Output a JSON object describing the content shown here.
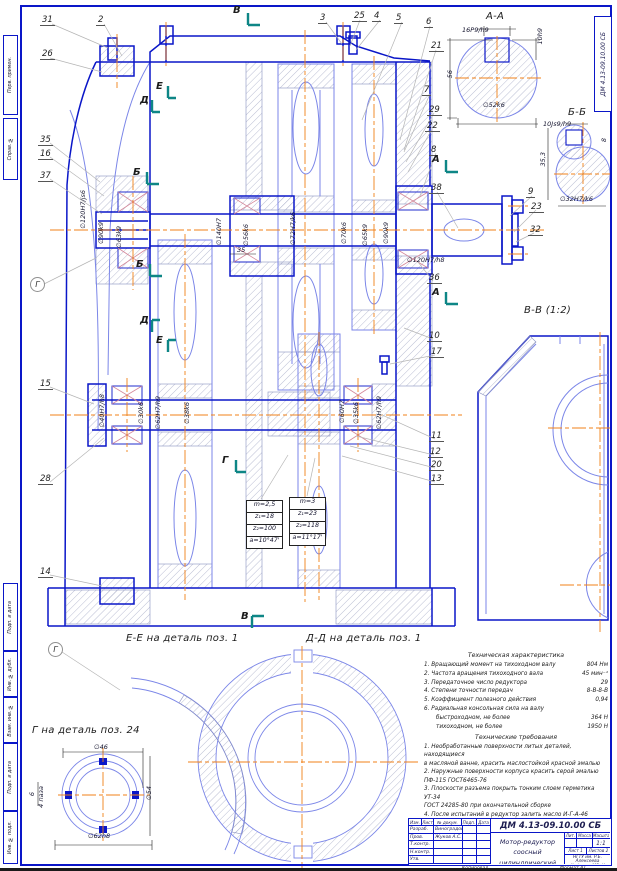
{
  "doc_code": "ДМ 4.13-09.10.00 СБ",
  "accent": {
    "line_blue": "#0a16c8",
    "thin_blue": "#7b86e8",
    "centerline_orange": "#f08018",
    "hatch": "#a8aec8"
  },
  "labels": [
    {
      "t": "А-А",
      "x": 486,
      "y": 12,
      "cls": "big"
    },
    {
      "t": "16P9/h9",
      "x": 462,
      "y": 27
    },
    {
      "t": "10h9",
      "x": 537,
      "y": 28,
      "cls": "v"
    },
    {
      "t": "56",
      "x": 447,
      "y": 70,
      "cls": "v"
    },
    {
      "t": "∅52k6",
      "x": 483,
      "y": 102
    },
    {
      "t": "Б-Б",
      "x": 568,
      "y": 108,
      "cls": "big"
    },
    {
      "t": "10Js9/h9",
      "x": 543,
      "y": 121
    },
    {
      "t": "35,3",
      "x": 540,
      "y": 152,
      "cls": "v"
    },
    {
      "t": "8",
      "x": 601,
      "y": 138,
      "cls": "v"
    },
    {
      "t": "∅32H7/k6",
      "x": 560,
      "y": 196
    },
    {
      "t": "В-В (1:2)",
      "x": 524,
      "y": 306,
      "cls": "big"
    },
    {
      "t": "∅120H7/js6",
      "x": 80,
      "y": 190,
      "cls": "v"
    },
    {
      "t": "∅90k9",
      "x": 98,
      "y": 222,
      "cls": "v"
    },
    {
      "t": "∅63k9",
      "x": 116,
      "y": 226,
      "cls": "v"
    },
    {
      "t": "∅140H7",
      "x": 216,
      "y": 218,
      "cls": "v"
    },
    {
      "t": "∅56k6",
      "x": 243,
      "y": 224,
      "cls": "v"
    },
    {
      "t": "∅72H7/k6",
      "x": 290,
      "y": 212,
      "cls": "v"
    },
    {
      "t": "35",
      "x": 237,
      "y": 247
    },
    {
      "t": "∅70k6",
      "x": 341,
      "y": 222,
      "cls": "v"
    },
    {
      "t": "∅65k9",
      "x": 362,
      "y": 224,
      "cls": "v"
    },
    {
      "t": "∅90k9",
      "x": 383,
      "y": 222,
      "cls": "v"
    },
    {
      "t": "∅120H7/h8",
      "x": 407,
      "y": 257
    },
    {
      "t": "∅40H7/h8",
      "x": 99,
      "y": 394,
      "cls": "v"
    },
    {
      "t": "∅30k6",
      "x": 138,
      "y": 402,
      "cls": "v"
    },
    {
      "t": "∅62H7/h9",
      "x": 155,
      "y": 396,
      "cls": "v"
    },
    {
      "t": "∅38k6",
      "x": 184,
      "y": 402,
      "cls": "v"
    },
    {
      "t": "∅60H7",
      "x": 339,
      "y": 400,
      "cls": "v"
    },
    {
      "t": "∅35k6",
      "x": 353,
      "y": 402,
      "cls": "v"
    },
    {
      "t": "∅62H7/h9",
      "x": 376,
      "y": 396,
      "cls": "v"
    },
    {
      "t": "Е-Е на деталь поз. 1",
      "x": 126,
      "y": 634,
      "cls": "big"
    },
    {
      "t": "Д-Д на деталь поз. 1",
      "x": 306,
      "y": 634,
      "cls": "big"
    },
    {
      "t": "Г на деталь поз. 24",
      "x": 32,
      "y": 726,
      "cls": "big"
    },
    {
      "t": "∅46",
      "x": 94,
      "y": 744
    },
    {
      "t": "∅54",
      "x": 146,
      "y": 786,
      "cls": "v"
    },
    {
      "t": "∅62h8",
      "x": 88,
      "y": 833
    },
    {
      "t": "6",
      "x": 29,
      "y": 792,
      "cls": "v"
    },
    {
      "t": "4 паза",
      "x": 38,
      "y": 786,
      "cls": "v"
    }
  ],
  "callouts": [
    {
      "n": "31",
      "x": 40,
      "y": 16
    },
    {
      "n": "2",
      "x": 96,
      "y": 16
    },
    {
      "n": "3",
      "x": 318,
      "y": 14
    },
    {
      "n": "25",
      "x": 352,
      "y": 12
    },
    {
      "n": "4",
      "x": 372,
      "y": 12
    },
    {
      "n": "5",
      "x": 394,
      "y": 14
    },
    {
      "n": "6",
      "x": 424,
      "y": 18
    },
    {
      "n": "21",
      "x": 429,
      "y": 42
    },
    {
      "n": "26",
      "x": 40,
      "y": 50
    },
    {
      "n": "7",
      "x": 422,
      "y": 86
    },
    {
      "n": "29",
      "x": 427,
      "y": 106
    },
    {
      "n": "22",
      "x": 425,
      "y": 122
    },
    {
      "n": "8",
      "x": 429,
      "y": 146
    },
    {
      "n": "38",
      "x": 429,
      "y": 184
    },
    {
      "n": "9",
      "x": 526,
      "y": 188
    },
    {
      "n": "23",
      "x": 529,
      "y": 203
    },
    {
      "n": "32",
      "x": 528,
      "y": 226
    },
    {
      "n": "36",
      "x": 427,
      "y": 274
    },
    {
      "n": "10",
      "x": 427,
      "y": 332
    },
    {
      "n": "17",
      "x": 429,
      "y": 348
    },
    {
      "n": "11",
      "x": 429,
      "y": 432
    },
    {
      "n": "12",
      "x": 428,
      "y": 448
    },
    {
      "n": "20",
      "x": 429,
      "y": 461
    },
    {
      "n": "13",
      "x": 429,
      "y": 475
    },
    {
      "n": "35",
      "x": 38,
      "y": 136
    },
    {
      "n": "16",
      "x": 38,
      "y": 150
    },
    {
      "n": "37",
      "x": 38,
      "y": 172
    },
    {
      "n": "15",
      "x": 38,
      "y": 380
    },
    {
      "n": "28",
      "x": 38,
      "y": 475
    },
    {
      "n": "14",
      "x": 38,
      "y": 568
    }
  ],
  "flags": [
    {
      "t": "В",
      "x": 233,
      "y": 6
    },
    {
      "t": "В",
      "x": 241,
      "y": 612
    },
    {
      "t": "А",
      "x": 432,
      "y": 155
    },
    {
      "t": "А",
      "x": 432,
      "y": 288
    },
    {
      "t": "Б",
      "x": 133,
      "y": 168
    },
    {
      "t": "Б",
      "x": 136,
      "y": 260
    },
    {
      "t": "Д",
      "x": 140,
      "y": 96
    },
    {
      "t": "Е",
      "x": 156,
      "y": 82
    },
    {
      "t": "Д",
      "x": 140,
      "y": 316
    },
    {
      "t": "Е",
      "x": 156,
      "y": 336
    },
    {
      "t": "Г",
      "x": 222,
      "y": 456
    },
    {
      "t": "Г",
      "x": 30,
      "y": 277,
      "cls": "circ"
    },
    {
      "t": "Г",
      "x": 48,
      "y": 642,
      "cls": "circ"
    }
  ],
  "frame_labels": [
    {
      "label": "Перв. примен.",
      "y": 35,
      "h": 80
    },
    {
      "label": "Справ. №",
      "y": 118,
      "h": 62
    },
    {
      "label": "Подп. и дата",
      "y": 583,
      "h": 68
    },
    {
      "label": "Инв. № дубл.",
      "y": 651,
      "h": 46
    },
    {
      "label": "Взам. инв. №",
      "y": 697,
      "h": 46
    },
    {
      "label": "Подп. и дата",
      "y": 743,
      "h": 68
    },
    {
      "label": "Инв. № подл.",
      "y": 811,
      "h": 53
    }
  ],
  "tables": {
    "t1": [
      {
        "t": "m=2,5"
      },
      {
        "t": "z₁=18"
      },
      {
        "t": "z₂=100"
      },
      {
        "t": "a=10°47'"
      }
    ],
    "t2": [
      {
        "t": "m=3"
      },
      {
        "t": "z₁=23"
      },
      {
        "t": "z₂=118"
      },
      {
        "t": "a=11°17'"
      }
    ]
  },
  "tech": {
    "chars_title": "Техническая характеристика",
    "chars": [
      {
        "t": "1. Вращающий момент на тихоходном валу",
        "v": "804 Нм"
      },
      {
        "t": "2. Частота вращения тихоходного вала",
        "v": "45 мин⁻¹"
      },
      {
        "t": "3. Передаточное число редуктора",
        "v": "29"
      },
      {
        "t": "4. Степени точности передач",
        "v": "8-В-8-В"
      },
      {
        "t": "5. Коэффициент полезного действия",
        "v": "0,94"
      },
      {
        "t": "6. Радиальная консольная сила на валу",
        "v": ""
      },
      {
        "t": "быстроходном, не более",
        "v": "364 Н",
        "cls": "ind"
      },
      {
        "t": "тихоходном, не более",
        "v": "1950 Н",
        "cls": "ind"
      }
    ],
    "reqs_title": "Технические требования",
    "reqs": [
      {
        "t": "1. Необработанные поверхности литых деталей, находящиеся"
      },
      {
        "t": "в масляной ванне, красить маслостойкой красной эмалью"
      },
      {
        "t": "2. Наружные поверхности корпуса красить серой эмалью"
      },
      {
        "t": "ПФ-115 ГОСТ6465-76"
      },
      {
        "t": "3. Плоскости разъема покрыть тонким слоем герметика УТ-34"
      },
      {
        "t": "ГОСТ 24285-80 при окончательной сборке"
      },
      {
        "t": "4. После испытаний в редуктор залить масло И-Г-А-46"
      },
      {
        "t": "в количестве 1л ГОСТ 20799-88"
      }
    ],
    "note_symbol": "Г",
    "note_text": "— герметик УТ-34 ГОСТ 24285-80"
  },
  "title_block": {
    "code": "ДМ 4.13-09.10.00 СБ",
    "product_line1": "Мотор-редуктор",
    "product_line2": "соосный цилиндрический",
    "cols": [
      "Изм.",
      "Лист",
      "№ докум.",
      "Подп.",
      "Дата"
    ],
    "roles": [
      {
        "role": "Разраб.",
        "name": "Виноградов Д."
      },
      {
        "role": "Пров.",
        "name": "Жуков А.С."
      },
      {
        "role": "Т.контр.",
        "name": ""
      },
      {
        "role": "Н.контр.",
        "name": ""
      },
      {
        "role": "Утв.",
        "name": ""
      }
    ],
    "lit_label": "Лит.",
    "mass_label": "Масса",
    "scale_label": "Масштаб",
    "scale_value": "1:1",
    "sheet": "Лист 1",
    "sheets": "Листов 2",
    "org_line1": "НГТУ им. Р.Е. Алексеева",
    "org_line2": "Кафедра МСиК",
    "org_line3": "Группа 09С3-81",
    "kopiroval": "Копировал",
    "format": "Формат А1"
  }
}
